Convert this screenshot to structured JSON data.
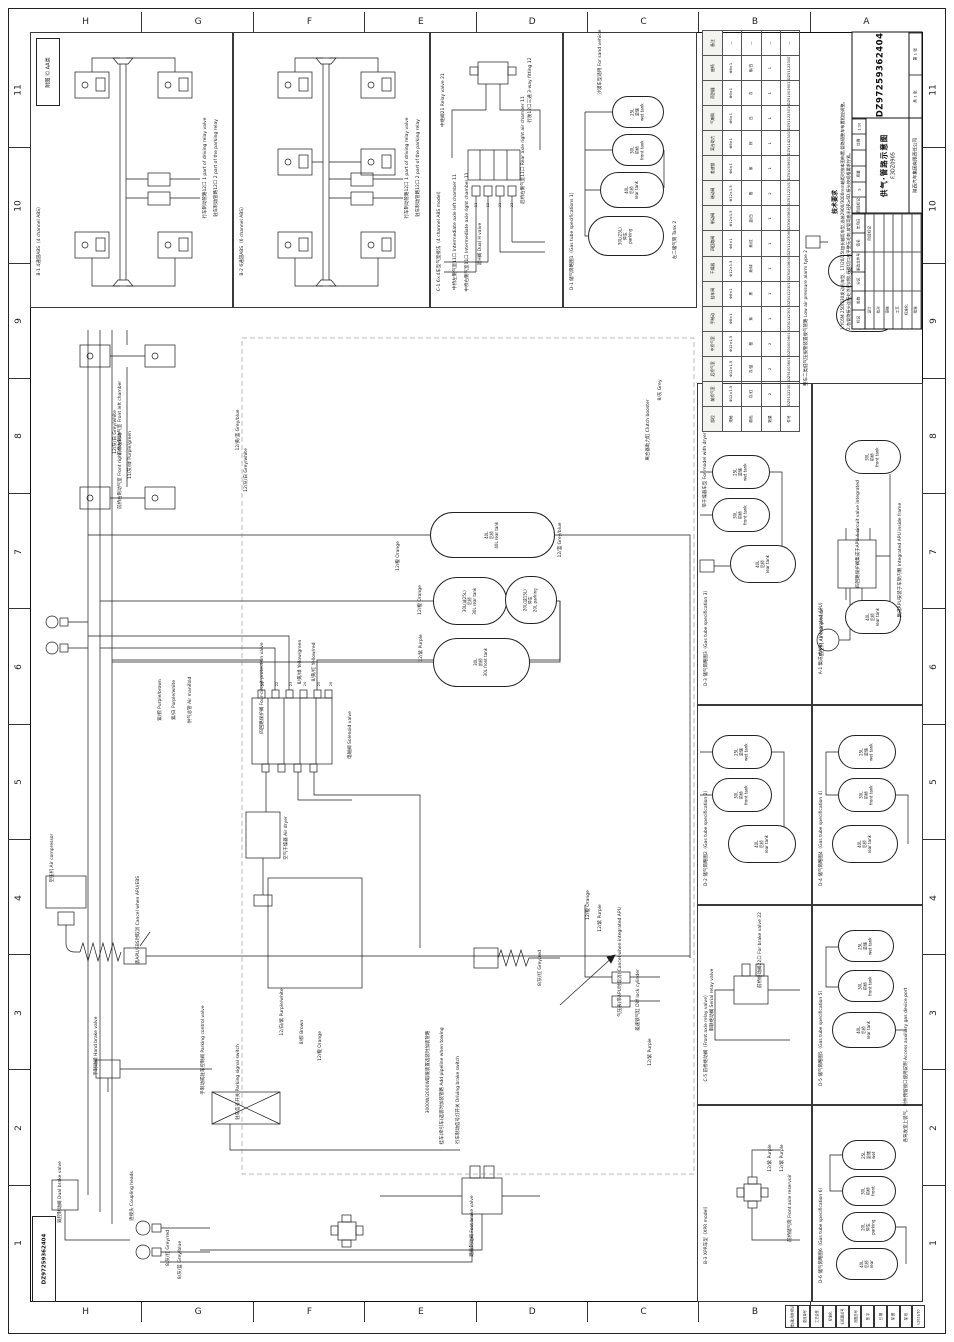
{
  "sheet": {
    "drawing_no": "DZ97259362404",
    "title_cn": "供气·管路示意图",
    "title_code": "F.3DZ0905",
    "company": "陕西汽车集团有限责任公司",
    "legend": "附图 Ⓒ AA类",
    "scale": "1:10",
    "sheet_count": "共 1 张",
    "sheet_no": "第 1 张"
  },
  "grid": {
    "columns": [
      "H",
      "G",
      "F",
      "E",
      "D",
      "C",
      "B",
      "A"
    ],
    "rows": [
      "11",
      "10",
      "9",
      "8",
      "7",
      "6",
      "5",
      "4",
      "3",
      "2",
      "1"
    ]
  },
  "title_block": {
    "rev_labels": [
      "标记",
      "处数",
      "分区",
      "更改文件号",
      "签名",
      "年月日"
    ],
    "role_rows": [
      [
        "设计",
        "",
        "阶段标记"
      ],
      [
        "校对",
        "",
        ""
      ],
      [
        "审核",
        "",
        ""
      ],
      [
        "工艺",
        "",
        ""
      ],
      [
        "标准化",
        "",
        ""
      ],
      [
        "批准",
        "",
        ""
      ]
    ],
    "mid_labels": [
      "阶段标记",
      "质量",
      "比例"
    ],
    "mid_values": [
      "S",
      "",
      "1:10"
    ]
  },
  "notes": {
    "heading": "技术要求",
    "lines": [
      "1.YC6M 250/330发动机车型、17/20/25t加长轴距车型,选装2900/3000mm轴距时按本图布置,管路随整车布置相应调整。",
      "2.各管路接头连接处涂密封胶,气管切口应平整无毛刺,软管弯曲半径R≥6D,接头按规格要求拧紧。",
      "3.管路走向布置合理,不得与相邻件干涉摩擦,每隔300~500mm用扎带可靠固定,过孔处加护套。",
      "4.整车气制动系统充气至额定气压后保压10min,压降不得超过0.01MPa,各接头处不得漏气。",
      "5.湿储气筒应定期排水,产品按要求涂漆防锈,随车文件交付齐全,选装件按订单配置执行。"
    ]
  },
  "panels": [
    {
      "id": "B-1",
      "cn": "4通道ABS",
      "en": "4 channel ABS",
      "x": 30,
      "y": 32,
      "w": 203,
      "h": 276
    },
    {
      "id": "B-2",
      "cn": "6通道ABS",
      "en": "6 channel ABS",
      "x": 233,
      "y": 32,
      "w": 197,
      "h": 276
    },
    {
      "id": "C-1",
      "cn": "6×4车型气室接法",
      "en": "4 channel ABS model",
      "x": 430,
      "y": 32,
      "w": 133,
      "h": 276
    },
    {
      "id": "D-1",
      "cn": "储气筒略图1",
      "en": "Gas tube specifications 1",
      "x": 563,
      "y": 32,
      "w": 134,
      "h": 276
    },
    {
      "id": "D-3",
      "cn": "储气筒略图3",
      "en": "Gas tube specification 3",
      "x": 697,
      "y": 383,
      "w": 115,
      "h": 322
    },
    {
      "id": "A-1",
      "cn": "集成式APU",
      "en": "Integrated APU",
      "x": 812,
      "y": 383,
      "w": 111,
      "h": 322
    },
    {
      "id": "D-2",
      "cn": "储气筒略图2",
      "en": "Gas tube specification 2",
      "x": 697,
      "y": 705,
      "w": 115,
      "h": 200
    },
    {
      "id": "D-4",
      "cn": "储气筒略图4",
      "en": "Gas tube specification 4",
      "x": 812,
      "y": 705,
      "w": 111,
      "h": 200
    },
    {
      "id": "C-5",
      "cn": "前桥继动阀",
      "en": "Front axle relay valve",
      "x": 697,
      "y": 905,
      "w": 115,
      "h": 200
    },
    {
      "id": "D-5",
      "cn": "储气筒略图5",
      "en": "Gas tube specification 5",
      "x": 812,
      "y": 905,
      "w": 111,
      "h": 200
    },
    {
      "id": "B-3",
      "cn": "XPR车型",
      "en": "XPR model",
      "x": 697,
      "y": 1105,
      "w": 115,
      "h": 197
    },
    {
      "id": "D-6",
      "cn": "储气筒略图6",
      "en": "Gas tube specification 6",
      "x": 812,
      "y": 1105,
      "w": 111,
      "h": 197
    }
  ],
  "tanks": [
    {
      "x": 430,
      "y": 512,
      "w": 125,
      "h": 46,
      "l": [
        "40L",
        "后桥",
        "40L rear tank"
      ]
    },
    {
      "x": 433,
      "y": 577,
      "w": 74,
      "h": 48,
      "l": [
        "30L(或25L)",
        "后桥",
        "30L rear tank"
      ]
    },
    {
      "x": 505,
      "y": 576,
      "w": 52,
      "h": 48,
      "l": [
        "20L(或15L)",
        "停车",
        "20L parking"
      ]
    },
    {
      "x": 433,
      "y": 638,
      "w": 97,
      "h": 49,
      "l": [
        "30L",
        "前桥",
        "30L front tank"
      ]
    },
    {
      "x": 612,
      "y": 96,
      "w": 52,
      "h": 32,
      "l": [
        "25L",
        "湿储",
        "wet tank"
      ]
    },
    {
      "x": 612,
      "y": 134,
      "w": 52,
      "h": 32,
      "l": [
        "30L",
        "前桥",
        "front tank"
      ]
    },
    {
      "x": 600,
      "y": 172,
      "w": 64,
      "h": 36,
      "l": [
        "40L",
        "后桥",
        "rear tank"
      ]
    },
    {
      "x": 588,
      "y": 216,
      "w": 76,
      "h": 40,
      "l": [
        "30L(25L)",
        "停车",
        "parking"
      ]
    },
    {
      "x": 712,
      "y": 455,
      "w": 58,
      "h": 34,
      "l": [
        "25L",
        "湿储",
        "wet tank"
      ]
    },
    {
      "x": 712,
      "y": 498,
      "w": 58,
      "h": 34,
      "l": [
        "30L",
        "前桥",
        "front tank"
      ]
    },
    {
      "x": 730,
      "y": 545,
      "w": 66,
      "h": 38,
      "l": [
        "40L",
        "后桥",
        "rear tank"
      ]
    },
    {
      "x": 845,
      "y": 440,
      "w": 56,
      "h": 34,
      "l": [
        "30L",
        "前桥",
        "front tank"
      ]
    },
    {
      "x": 845,
      "y": 600,
      "w": 56,
      "h": 34,
      "l": [
        "40L",
        "后桥",
        "rear tank"
      ]
    },
    {
      "x": 712,
      "y": 735,
      "w": 60,
      "h": 34,
      "l": [
        "25L",
        "湿储",
        "wet tank"
      ]
    },
    {
      "x": 712,
      "y": 778,
      "w": 60,
      "h": 34,
      "l": [
        "30L",
        "前桥",
        "front tank"
      ]
    },
    {
      "x": 728,
      "y": 825,
      "w": 68,
      "h": 38,
      "l": [
        "40L",
        "后桥",
        "rear tank"
      ]
    },
    {
      "x": 838,
      "y": 735,
      "w": 58,
      "h": 34,
      "l": [
        "25L",
        "湿储",
        "wet tank"
      ]
    },
    {
      "x": 838,
      "y": 778,
      "w": 58,
      "h": 34,
      "l": [
        "30L",
        "前桥",
        "front tank"
      ]
    },
    {
      "x": 832,
      "y": 825,
      "w": 66,
      "h": 38,
      "l": [
        "40L",
        "后桥",
        "rear tank"
      ]
    },
    {
      "x": 838,
      "y": 930,
      "w": 56,
      "h": 32,
      "l": [
        "25L",
        "湿储",
        "wet tank"
      ]
    },
    {
      "x": 838,
      "y": 970,
      "w": 56,
      "h": 32,
      "l": [
        "30L",
        "前桥",
        "front tank"
      ]
    },
    {
      "x": 832,
      "y": 1012,
      "w": 64,
      "h": 36,
      "l": [
        "40L",
        "后桥",
        "rear tank"
      ]
    },
    {
      "x": 842,
      "y": 1140,
      "w": 54,
      "h": 30,
      "l": [
        "25L",
        "湿储",
        "wet"
      ]
    },
    {
      "x": 842,
      "y": 1176,
      "w": 54,
      "h": 30,
      "l": [
        "30L",
        "前桥",
        "front"
      ]
    },
    {
      "x": 842,
      "y": 1212,
      "w": 54,
      "h": 30,
      "l": [
        "20L",
        "停车",
        "parking"
      ]
    },
    {
      "x": 836,
      "y": 1248,
      "w": 62,
      "h": 32,
      "l": [
        "40L",
        "后桥",
        "rear"
      ]
    },
    {
      "x": 828,
      "y": 255,
      "w": 56,
      "h": 32,
      "l": [
        "30L",
        "前桥",
        "front tank"
      ]
    },
    {
      "x": 836,
      "y": 298,
      "w": 60,
      "h": 34,
      "l": [
        "40L",
        "后桥",
        "rear tank"
      ]
    }
  ],
  "labels": [
    {
      "x": 205,
      "y": 168,
      "t": "行车制动管路12口 1 part of driving relay valve"
    },
    {
      "x": 216,
      "y": 168,
      "t": "驻车制动管路12口 2 part of the parking relay"
    },
    {
      "x": 407,
      "y": 168,
      "t": "行车制动管路12口 1 part of driving relay valve"
    },
    {
      "x": 418,
      "y": 168,
      "t": "驻车制动管路12口 2 part of the parking relay"
    },
    {
      "x": 443,
      "y": 100,
      "t": "中继阀21 Relay valve 21"
    },
    {
      "x": 530,
      "y": 90,
      "t": "行驶12口三通 3-way fitting 12"
    },
    {
      "x": 523,
      "y": 150,
      "t": "后桥右侧气室11口 Rear axle right air chamber 11"
    },
    {
      "x": 455,
      "y": 232,
      "t": "中桥左侧气室11口 Intermediate axle left chamber 11"
    },
    {
      "x": 467,
      "y": 232,
      "t": "中桥右侧气室11口 Intermediate axle right chamber 11"
    },
    {
      "x": 480,
      "y": 244,
      "t": "双H阀 Dual H valve"
    },
    {
      "x": 476,
      "y": 205,
      "t": "11",
      "s": 3.5
    },
    {
      "x": 488,
      "y": 205,
      "t": "12",
      "s": 3.5
    },
    {
      "x": 500,
      "y": 205,
      "t": "21",
      "s": 3.5
    },
    {
      "x": 512,
      "y": 205,
      "t": "22",
      "s": 3.5
    },
    {
      "x": 600,
      "y": 62,
      "t": "沙漠车型适用 For sand vehicle"
    },
    {
      "x": 675,
      "y": 240,
      "t": "左二储气筒 Tank 2"
    },
    {
      "x": 120,
      "y": 418,
      "t": "前桥左制动气室 Front left chamber"
    },
    {
      "x": 120,
      "y": 470,
      "t": "前桥右制动气室 Front right chamber"
    },
    {
      "x": 115,
      "y": 432,
      "t": "12/灰/白 Grey/white"
    },
    {
      "x": 130,
      "y": 455,
      "t": "11/灰/绿 Purple/green"
    },
    {
      "x": 238,
      "y": 430,
      "t": "12/黄/蓝 Grey/blue"
    },
    {
      "x": 52,
      "y": 858,
      "t": "空压机 Air compressor"
    },
    {
      "x": 138,
      "y": 920,
      "t": "装APU/EBS时取消 Cancel when APU/EBS"
    },
    {
      "x": 262,
      "y": 688,
      "t": "四回路保护阀 Four-circuit protection valve"
    },
    {
      "x": 350,
      "y": 735,
      "t": "电磁阀 Solenoid valve"
    },
    {
      "x": 262,
      "y": 686,
      "t": "",
      "s": 3.5
    },
    {
      "x": 263,
      "y": 684,
      "t": "21",
      "s": 3.5
    },
    {
      "x": 277,
      "y": 684,
      "t": "22",
      "s": 3.5
    },
    {
      "x": 291,
      "y": 684,
      "t": "23",
      "s": 3.5
    },
    {
      "x": 305,
      "y": 684,
      "t": "24",
      "s": 3.5
    },
    {
      "x": 319,
      "y": 684,
      "t": "25",
      "s": 3.5
    },
    {
      "x": 331,
      "y": 684,
      "t": "26",
      "s": 3.5
    },
    {
      "x": 286,
      "y": 838,
      "t": "空气干燥器 Air dryer"
    },
    {
      "x": 96,
      "y": 1046,
      "t": "手制动阀 Hand brake valve"
    },
    {
      "x": 203,
      "y": 1050,
      "t": "手制动或驻车控制阀 Parking control valve"
    },
    {
      "x": 238,
      "y": 1082,
      "t": "驻车信号开关 Parking signal switch"
    },
    {
      "x": 428,
      "y": 1072,
      "t": "3000W/2000W取暖装置选装时加装管路"
    },
    {
      "x": 442,
      "y": 1086,
      "t": "挂车(牵引车)选装时加装管路 Add pipeline when towing"
    },
    {
      "x": 458,
      "y": 1100,
      "t": "行车制动信号灯开关 Driving brake switch"
    },
    {
      "x": 472,
      "y": 1226,
      "t": "踏板制动阀 Foot brake valve"
    },
    {
      "x": 60,
      "y": 1192,
      "t": "双腔制动阀 Dual brake valve"
    },
    {
      "x": 132,
      "y": 1196,
      "t": "连接头 Coupling heads"
    },
    {
      "x": 168,
      "y": 1248,
      "t": "8/灰/红 Grey/red"
    },
    {
      "x": 180,
      "y": 1260,
      "t": "8/灰/蓝 Grey/blue"
    },
    {
      "x": 620,
      "y": 962,
      "t": "气压表(带APU时取消) Cancel when integrated APU"
    },
    {
      "x": 638,
      "y": 1000,
      "t": "差速锁气缸 Diff lock cylinder"
    },
    {
      "x": 650,
      "y": 1052,
      "t": "12/紫 Purple"
    },
    {
      "x": 398,
      "y": 556,
      "t": "12/橙 Orange"
    },
    {
      "x": 420,
      "y": 600,
      "t": "12/橙 Orange"
    },
    {
      "x": 421,
      "y": 648,
      "t": "12/紫 Purple"
    },
    {
      "x": 560,
      "y": 540,
      "t": "12/蓝 Grey/blue"
    },
    {
      "x": 588,
      "y": 905,
      "t": "12/橙 Orange"
    },
    {
      "x": 600,
      "y": 918,
      "t": "12/紫 Purple"
    },
    {
      "x": 246,
      "y": 470,
      "t": "12/灰/白 Grey/white"
    },
    {
      "x": 300,
      "y": 662,
      "t": "8/黄/绿 Yellow/green"
    },
    {
      "x": 314,
      "y": 662,
      "t": "8/黄/红 Yellow/red"
    },
    {
      "x": 160,
      "y": 700,
      "t": "紫/棕 Purple/brown"
    },
    {
      "x": 174,
      "y": 700,
      "t": "紫/白 Purple/white"
    },
    {
      "x": 190,
      "y": 700,
      "t": "供气总管 Air manifold"
    },
    {
      "x": 540,
      "y": 968,
      "t": "8/灰/红 Grey/red"
    },
    {
      "x": 282,
      "y": 1012,
      "t": "12/白/紫 Purple/white"
    },
    {
      "x": 302,
      "y": 1032,
      "t": "8/棕 Brown"
    },
    {
      "x": 320,
      "y": 1046,
      "t": "12/橙 Orange"
    },
    {
      "x": 660,
      "y": 390,
      "t": "8/灰 Grey"
    },
    {
      "x": 648,
      "y": 430,
      "t": "离合器助力缸 Clutch booster"
    },
    {
      "x": 705,
      "y": 470,
      "t": "带干燥器车型 For model with dryer"
    },
    {
      "x": 900,
      "y": 560,
      "t": "集成APU安装于车架内侧 Integrated APU inside frame"
    },
    {
      "x": 822,
      "y": 632,
      "t": "空压机 Air compressor"
    },
    {
      "x": 858,
      "y": 534,
      "t": "四回路保护阀集成于APU 4-circuit valve integrated"
    },
    {
      "x": 760,
      "y": 950,
      "t": "前桥继动阀22口 For brake valve 22"
    },
    {
      "x": 712,
      "y": 1000,
      "t": "串联继动阀 Serial relay valve"
    },
    {
      "x": 770,
      "y": 1158,
      "t": "12/紫 Purple"
    },
    {
      "x": 782,
      "y": 1158,
      "t": "12/紫 Purple"
    },
    {
      "x": 790,
      "y": 1208,
      "t": "前桥储气筒 Front axle reservoir"
    },
    {
      "x": 906,
      "y": 1065,
      "t": "各驾驶室上装气、附件预留接口使用说明 Access auxiliary gas device port"
    },
    {
      "x": 806,
      "y": 318,
      "t": "整车二类低气压报警装置接气管路 Low air pressure alarm type 2"
    },
    {
      "x": 870,
      "y": 238,
      "t": "8/灰/红 Grey/red"
    }
  ],
  "parts_table": {
    "rows": [
      [
        "部位",
        "前桥气室",
        "后桥气室",
        "中桥气室",
        "手制动",
        "挂车阀",
        "干燥器",
        "四回路阀",
        "制动阀",
        "继动阀",
        "差速锁",
        "离合助力",
        "气喇叭",
        "雨刮器",
        "座椅",
        "备注"
      ],
      [
        "规格",
        "Φ12×1.5",
        "Φ12×1.5",
        "Φ12×1.5",
        "Φ8×1",
        "Φ8×1",
        "Φ12×1.5",
        "Φ8×1",
        "Φ12×1.5",
        "Φ12×1.5",
        "Φ6×1",
        "Φ8×1",
        "Φ6×1",
        "Φ6×1",
        "Φ8×1",
        "—"
      ],
      [
        "颜色",
        "灰/红",
        "灰/蓝",
        "橙",
        "紫",
        "黑",
        "黄/绿",
        "黄/红",
        "蓝/白",
        "橙",
        "紫",
        "棕",
        "白",
        "灰",
        "紫/白",
        "—"
      ],
      [
        "数量",
        "2",
        "2",
        "2",
        "1",
        "1",
        "1",
        "1",
        "1",
        "2",
        "1",
        "1",
        "1",
        "1",
        "1",
        "—"
      ],
      [
        "件号",
        "DZ9112230176",
        "DZ9100360113",
        "DZ9100360158",
        "DZ9114230101",
        "DZ9112230132",
        "DZ9100360076",
        "DZ9112230901",
        "DZ9160360131",
        "DZ9112230176",
        "DZ9100360113",
        "DZ9114230158",
        "DZ9112230101",
        "DZ9100360132",
        "DZ9112230076",
        "—"
      ]
    ]
  },
  "revision_strip": [
    "借(通)用件登记",
    "更改单号",
    "工艺会签",
    "标准化",
    "旧底图总号",
    "底图总号",
    "签 字",
    "日 期",
    "描 图",
    "描 校",
    "L2021/10"
  ]
}
